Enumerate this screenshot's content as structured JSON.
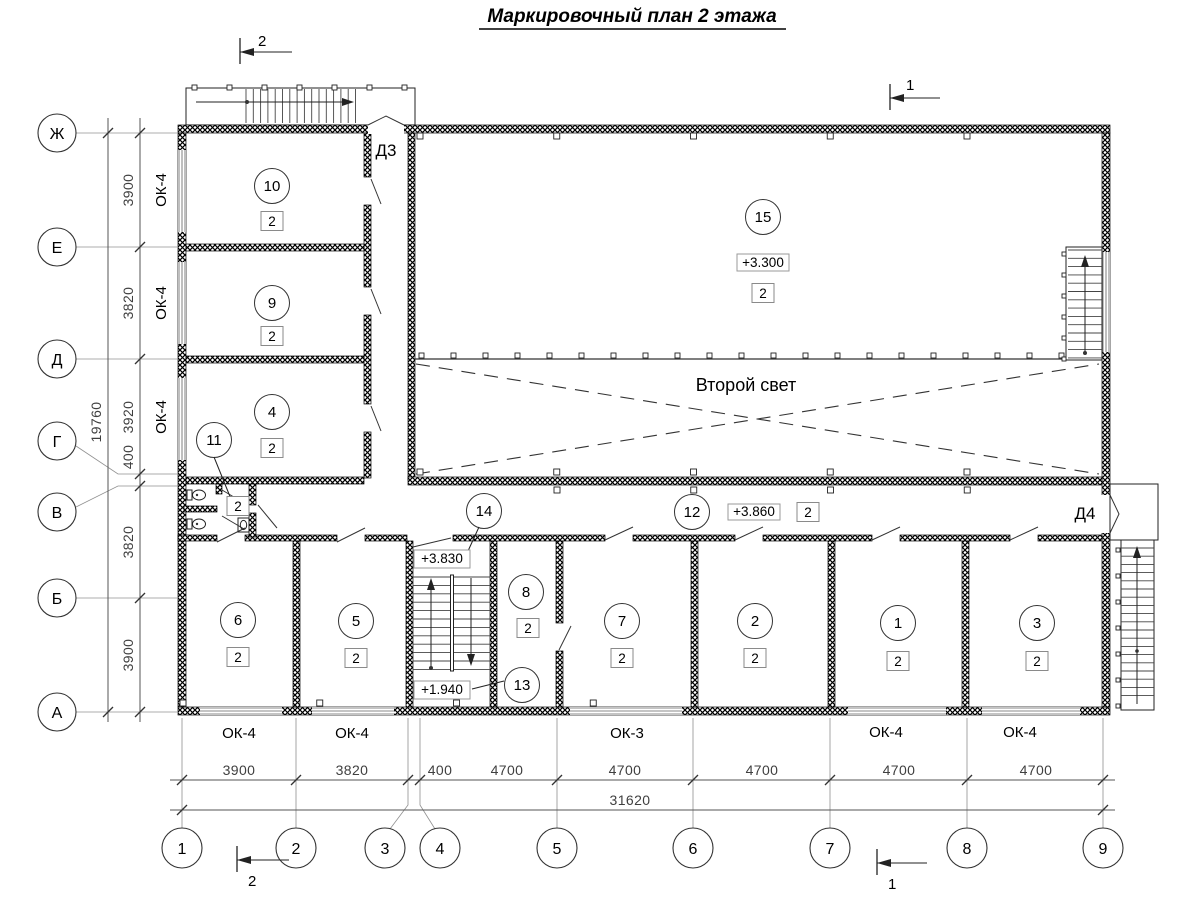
{
  "title": "Маркировочный план 2 этажа",
  "colors": {
    "ink": "#000000",
    "paper": "#ffffff"
  },
  "axes": {
    "bottom": [
      "1",
      "2",
      "3",
      "4",
      "5",
      "6",
      "7",
      "8",
      "9"
    ],
    "left": [
      "Ж",
      "Е",
      "Д",
      "Г",
      "В",
      "Б",
      "А"
    ]
  },
  "dims": {
    "bottom": [
      "3900",
      "3820",
      "400",
      "4700",
      "4700",
      "4700",
      "4700",
      "4700"
    ],
    "bottom_total": "31620",
    "left": [
      "3900",
      "3820",
      "3920",
      "400",
      "3820",
      "3900"
    ],
    "left_total": "19760"
  },
  "windows": {
    "bottom": [
      "ОК-4",
      "ОК-4",
      "ОК-3",
      "ОК-4",
      "ОК-4"
    ],
    "left": [
      "ОК-4",
      "ОК-4",
      "ОК-4"
    ]
  },
  "rooms": {
    "r1": {
      "number": "1",
      "badge": "2"
    },
    "r2": {
      "number": "2",
      "badge": "2"
    },
    "r3": {
      "number": "3",
      "badge": "2"
    },
    "r4": {
      "number": "4",
      "badge": "2"
    },
    "r5": {
      "number": "5",
      "badge": "2"
    },
    "r6": {
      "number": "6",
      "badge": "2"
    },
    "r7": {
      "number": "7",
      "badge": "2"
    },
    "r8": {
      "number": "8",
      "badge": "2"
    },
    "r9": {
      "number": "9",
      "badge": "2"
    },
    "r10": {
      "number": "10",
      "badge": "2"
    },
    "r11": {
      "number": "11",
      "badge": "2"
    },
    "r12": {
      "number": "12",
      "badge": "2"
    },
    "r13": {
      "number": "13"
    },
    "r14": {
      "number": "14"
    },
    "r15": {
      "number": "15",
      "badge": "2"
    }
  },
  "elevations": {
    "hall": "+3.300",
    "corridor": "+3.860",
    "stair_upper": "+3.830",
    "stair_lower": "+1.940"
  },
  "doors": {
    "d3": "Д3",
    "d4": "Д4"
  },
  "labels": {
    "second_light": "Второй свет"
  },
  "sections": {
    "s1": "1",
    "s2": "2"
  }
}
